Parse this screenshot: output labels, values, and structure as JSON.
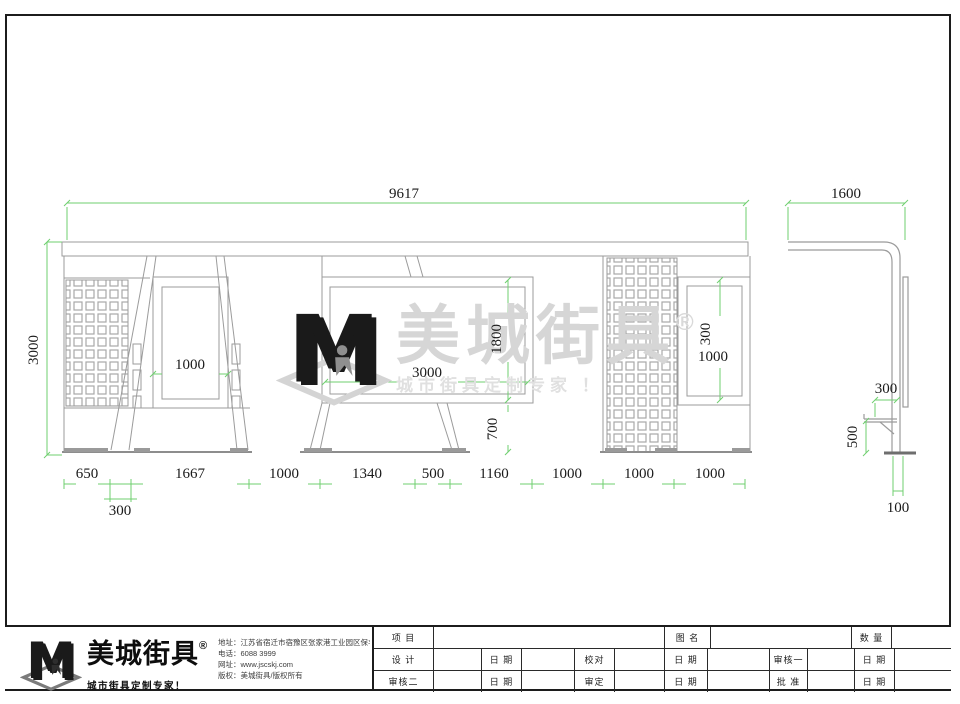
{
  "drawing": {
    "front": {
      "total_width": "9617",
      "height": "3000",
      "poster_left": "1000",
      "billboard_width": "3000",
      "billboard_height": "1800",
      "under_billboard": "700",
      "poster_right_inner": "300",
      "poster_right": "1000",
      "bottom_dims": [
        "650",
        "1667",
        "1000",
        "1340",
        "500",
        "1160",
        "1000",
        "1000",
        "1000"
      ],
      "foot_width": "300"
    },
    "side": {
      "width": "1600",
      "seat_depth": "300",
      "seat_height": "500",
      "post_base": "100"
    },
    "colors": {
      "dimension_green": "#6fcf6f",
      "structure_gray": "#9b9b9b",
      "logo_green": "#7fc241"
    }
  },
  "watermark": {
    "brand": "美城街具",
    "reg": "®",
    "tagline": "城市街具定制专家 ！"
  },
  "footer": {
    "logo": {
      "brand": "美城街具",
      "reg": "®",
      "tagline": "城市街具定制专家！"
    },
    "contact": {
      "address": "地址：江苏省宿迁市宿豫区张家港工业园区保丰路南侧1号",
      "phone": "电话：6088 3999",
      "website": "网址：www.jscskj.com",
      "copyright": "版权：美城街具/版权所有"
    },
    "titleblock": {
      "r1c1": "项 目",
      "r1c2": "图 名",
      "r1c3": "数 量",
      "r2c1": "设 计",
      "r2c2": "日 期",
      "r2c3": "校对",
      "r2c4": "日 期",
      "r2c5": "审核一",
      "r2c6": "日 期",
      "r3c1": "审核二",
      "r3c2": "日 期",
      "r3c3": "审定",
      "r3c4": "日 期",
      "r3c5": "批 准",
      "r3c6": "日 期"
    }
  }
}
